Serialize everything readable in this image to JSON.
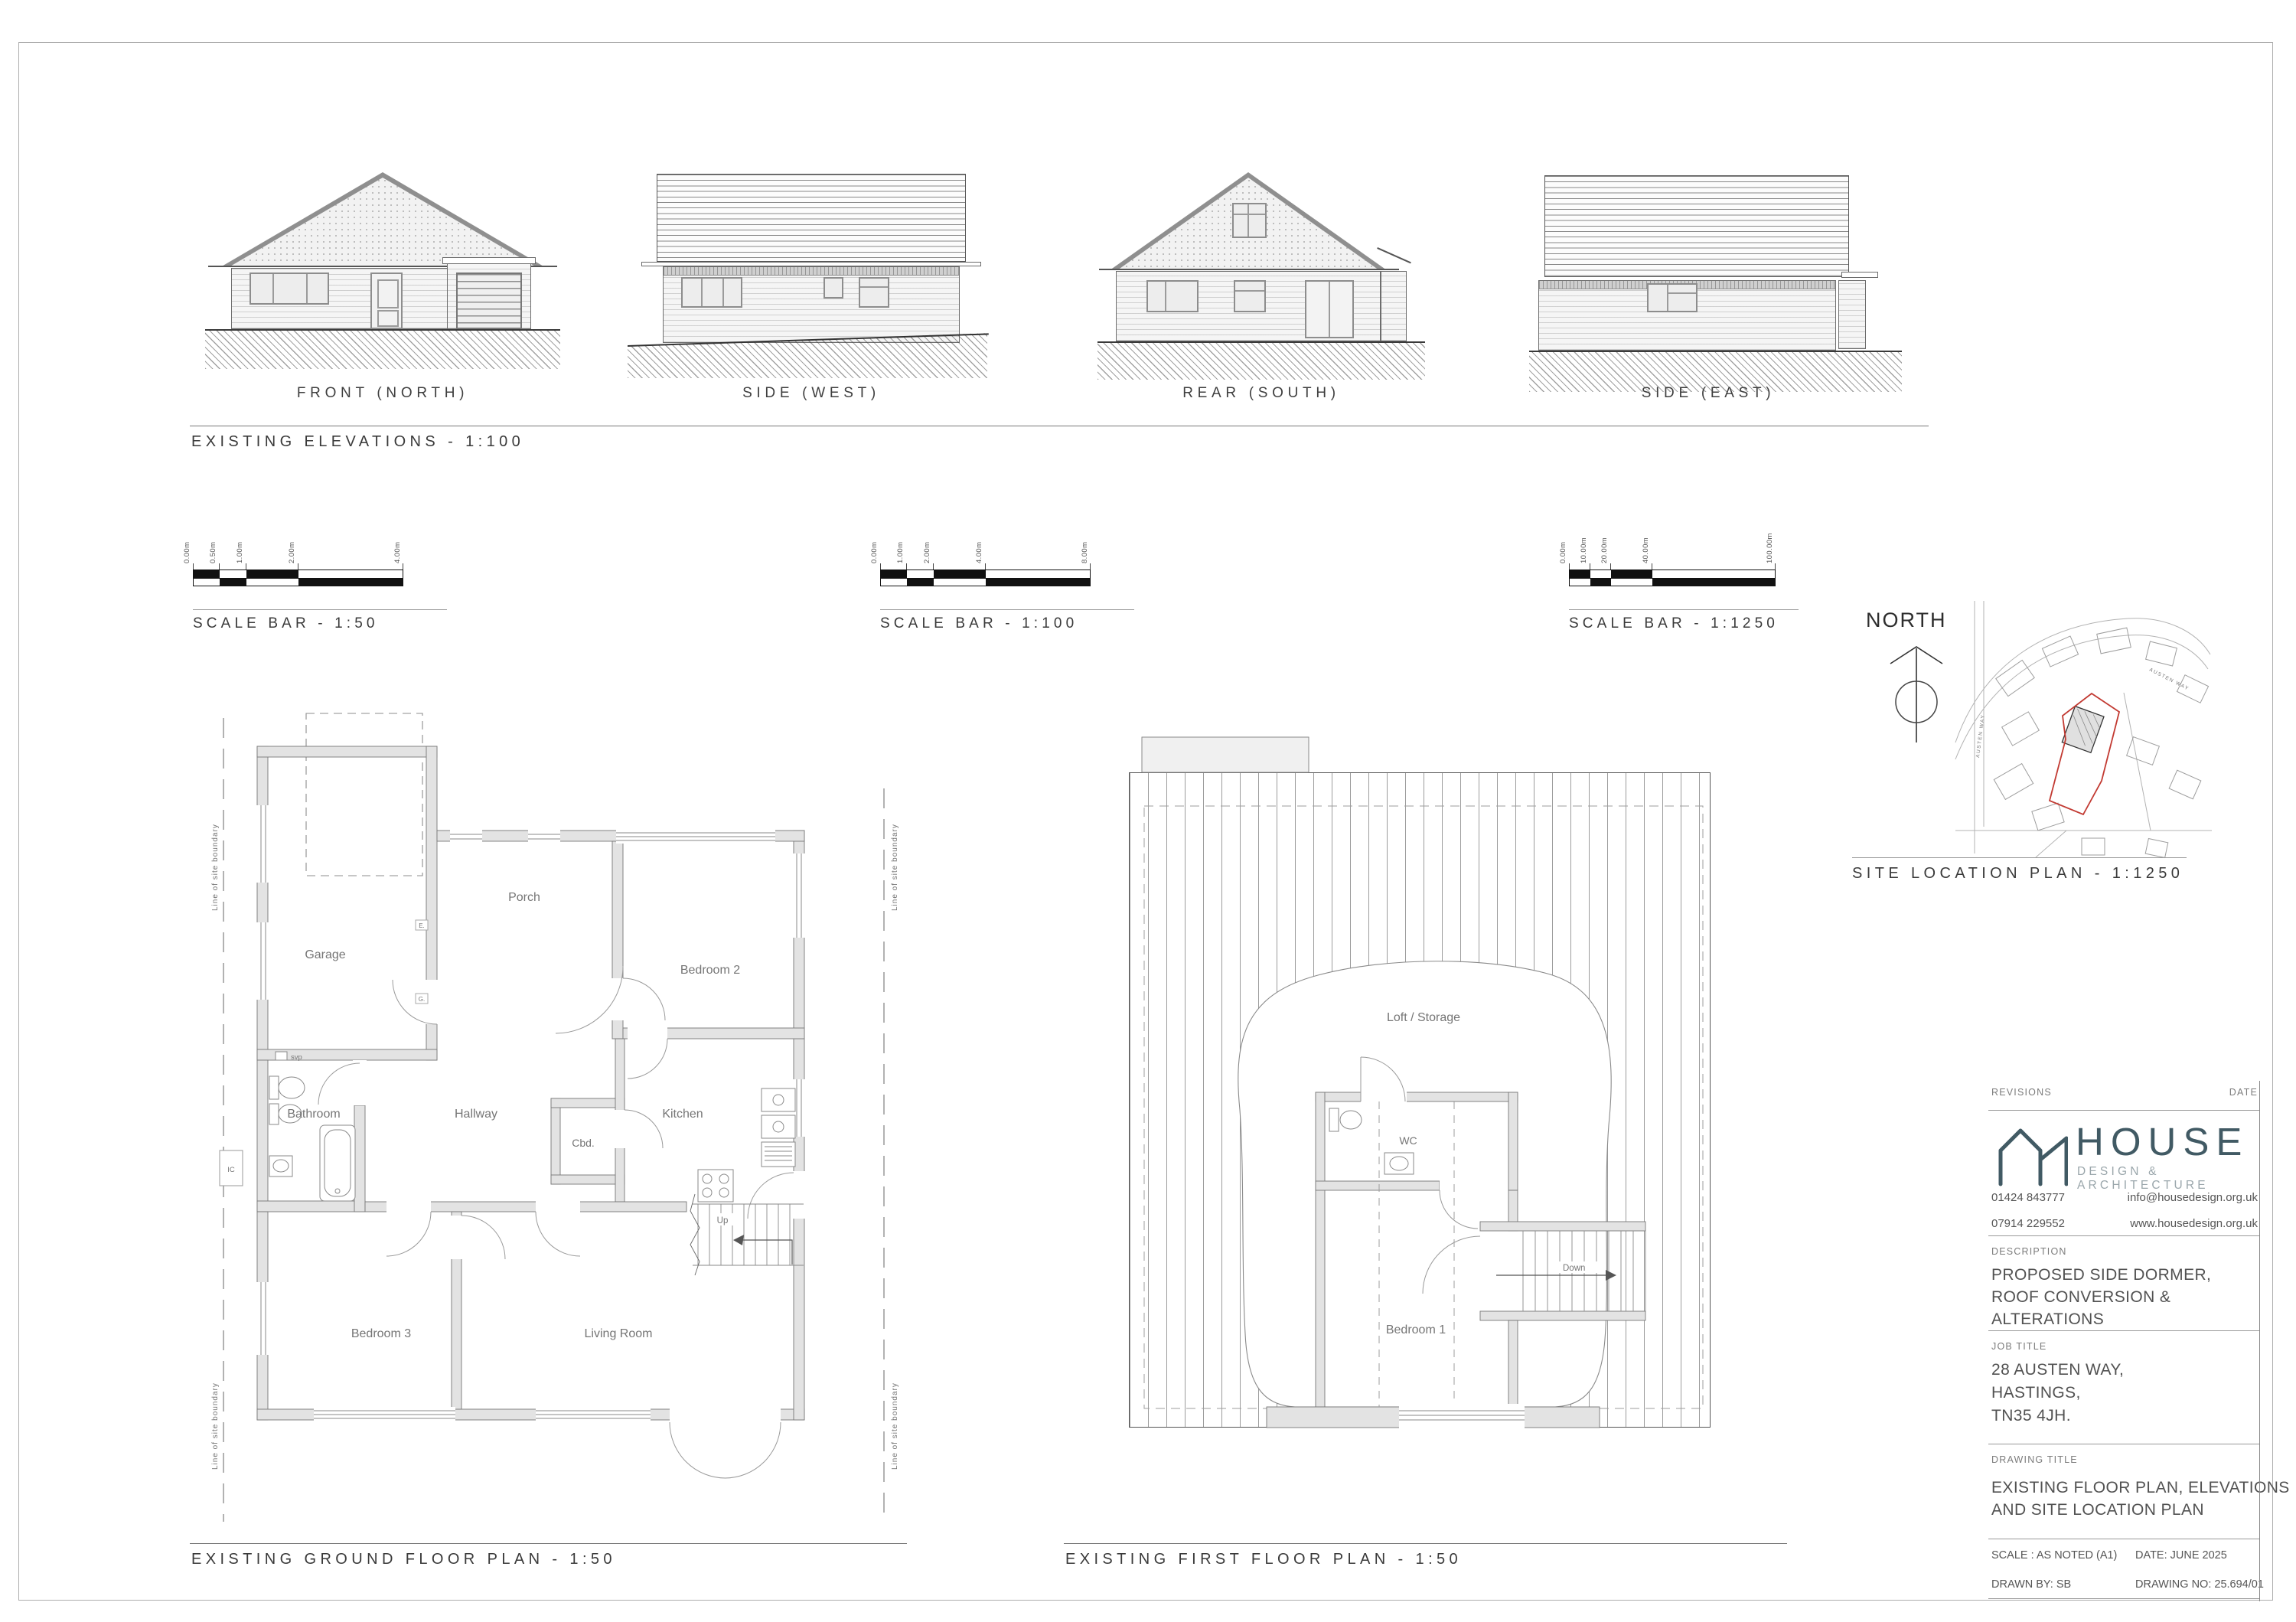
{
  "sheet": {
    "border_color": "#adadad",
    "boundary_red": "#c23a32"
  },
  "elevations": {
    "title": "EXISTING ELEVATIONS - 1:100",
    "items": [
      {
        "label": "FRONT (NORTH)"
      },
      {
        "label": "SIDE (WEST)"
      },
      {
        "label": "REAR (SOUTH)"
      },
      {
        "label": "SIDE (EAST)"
      }
    ]
  },
  "scale_bars": [
    {
      "label": "SCALE BAR - 1:50",
      "ticks": [
        "0.00m",
        "0.50m",
        "1.00m",
        "2.00m",
        "4.00m"
      ]
    },
    {
      "label": "SCALE BAR - 1:100",
      "ticks": [
        "0.00m",
        "1.00m",
        "2.00m",
        "4.00m",
        "8.00m"
      ]
    },
    {
      "label": "SCALE BAR - 1:1250",
      "ticks": [
        "0.00m",
        "10.00m",
        "20.00m",
        "40.00m",
        "100.00m"
      ]
    }
  ],
  "north_label": "NORTH",
  "site_plan": {
    "title": "SITE LOCATION PLAN - 1:1250",
    "street": "AUSTEN WAY"
  },
  "ground_floor": {
    "title": "EXISTING GROUND FLOOR PLAN - 1:50",
    "boundary_label": "Line of site boundary",
    "rooms": {
      "garage": "Garage",
      "porch": "Porch",
      "bedroom2": "Bedroom 2",
      "cbd": "Cbd.",
      "bathroom": "Bathroom",
      "hallway": "Hallway",
      "kitchen": "Kitchen",
      "bedroom3": "Bedroom 3",
      "living_room": "Living Room"
    },
    "notes": {
      "svp": "svp",
      "ic": "IC",
      "up": "Up",
      "e": "E.",
      "g": "G."
    }
  },
  "first_floor": {
    "title": "EXISTING FIRST FLOOR PLAN - 1:50",
    "rooms": {
      "loft": "Loft / Storage",
      "wc": "WC",
      "bedroom1": "Bedroom 1"
    },
    "notes": {
      "down": "Down"
    }
  },
  "title_block": {
    "revisions_label": "REVISIONS",
    "date_label": "DATE",
    "brand": "HOUSE",
    "brand_sub": "DESIGN & ARCHITECTURE",
    "phone1": "01424 843777",
    "phone2": "07914 229552",
    "email": "info@housedesign.org.uk",
    "website": "www.housedesign.org.uk",
    "description_label": "DESCRIPTION",
    "description": "PROPOSED SIDE DORMER, ROOF CONVERSION & ALTERATIONS",
    "job_title_label": "JOB TITLE",
    "job_lines": [
      "28 AUSTEN WAY,",
      "HASTINGS,",
      "TN35 4JH."
    ],
    "drawing_title_label": "DRAWING  TITLE",
    "drawing_lines": [
      "EXISTING FLOOR PLAN, ELEVATIONS",
      "AND SITE LOCATION PLAN"
    ],
    "scale": "SCALE : AS NOTED (A1)",
    "date": "DATE: JUNE 2025",
    "drawn_by": "DRAWN BY: SB",
    "drawing_no": "DRAWING NO: 25.694/01"
  }
}
